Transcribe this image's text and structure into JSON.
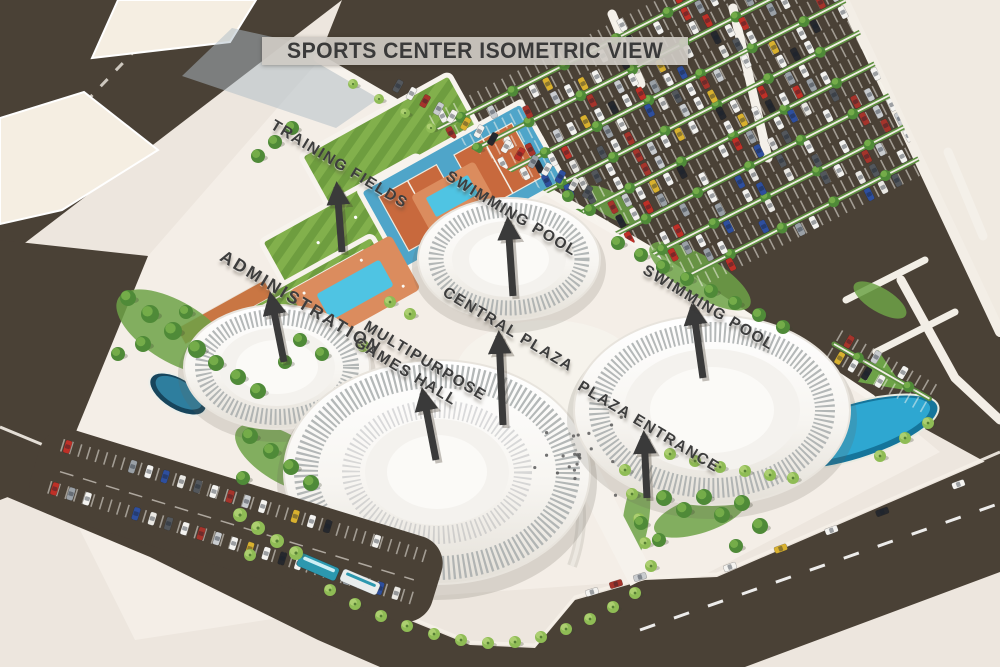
{
  "title": {
    "text": "SPORTS CENTER ISOMETRIC VIEW"
  },
  "annotations": [
    {
      "id": "training-fields",
      "text": "TRAINING FIELDS"
    },
    {
      "id": "swimming-pool-north",
      "text": "SWIMMING POOL"
    },
    {
      "id": "administration",
      "text": "ADMINISTRATION"
    },
    {
      "id": "central-plaza",
      "text": "CENTRAL PLAZA"
    },
    {
      "id": "multipurpose-games-hall",
      "text": "MULTIPURPOSE\nGAMES HALL"
    },
    {
      "id": "swimming-pool-east",
      "text": "SWIMMING POOL"
    },
    {
      "id": "plaza-entrance",
      "text": "PLAZA ENTRANCE"
    }
  ],
  "colors": {
    "road": "#4A4136",
    "ground": "#EDE6DE",
    "site": "#F4EEE7",
    "lawn": "#6E9D3F",
    "lawn_stripe": "#82B04C",
    "tennis_court": "#C8693D",
    "tennis_apron": "#4FA5C9",
    "pool_water": "#4FC4E3",
    "pond": "#1F6E90",
    "building": "#FFFFFF",
    "building_ribs": "#A7ABAC",
    "label_text": "#3D3D3D",
    "banner_bg": "#CBC8C1",
    "tree": "#4F8A38",
    "palm": "#8FBC55",
    "arrow": "#3A3A3A"
  }
}
